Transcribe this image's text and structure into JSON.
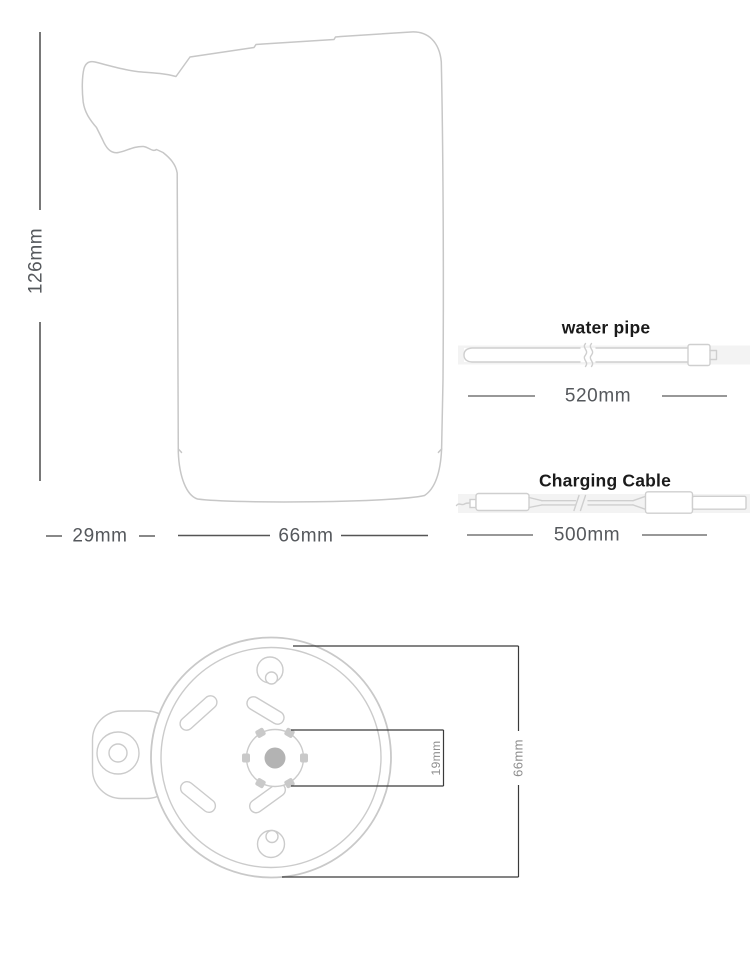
{
  "side_view": {
    "height": "126mm",
    "spout_width": "29mm",
    "body_width": "66mm"
  },
  "water_pipe": {
    "label": "water pipe",
    "length": "520mm"
  },
  "charging_cable": {
    "label": "Charging Cable",
    "length": "500mm"
  },
  "bottom_view": {
    "hub_width": "19mm",
    "base_diameter": "66mm"
  },
  "colors": {
    "outline_gray": "#c7c7c7",
    "dim_line": "#3f3f3f",
    "dim_text": "#55585c",
    "small_dim_text": "#8e8e8e",
    "label_text": "#1b1b1b",
    "hub_dot": "#b3b3b3",
    "shadow_strip": "#f3f3f3"
  }
}
